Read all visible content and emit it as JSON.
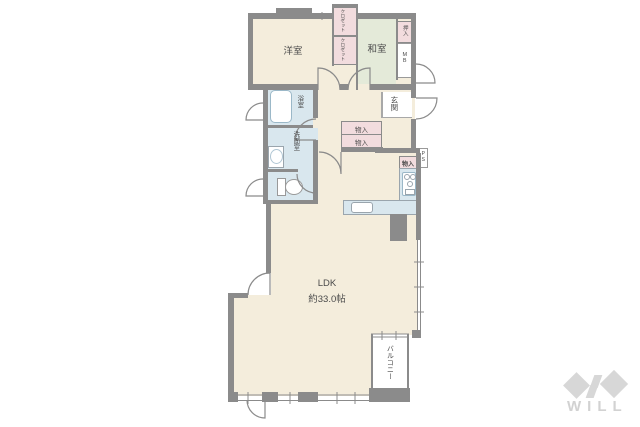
{
  "plan": {
    "rooms": {
      "western_room": "洋室",
      "japanese_room": "和室",
      "bath": "浴室",
      "washroom": "洗面室",
      "entrance": "玄関",
      "balcony": "バルコニー"
    },
    "area_label": {
      "line1": "LDK",
      "line2": "約33.0帖"
    },
    "storage": {
      "closets": [
        "クロゼット",
        "クロゼット"
      ],
      "oshiire": "押入",
      "hall_storage": [
        "物入",
        "物入"
      ],
      "kitchen_storage": "物入"
    },
    "utility": {
      "meter_box": "MB",
      "pipe_space": "PS"
    },
    "colors": {
      "room_beige": "#f4eddc",
      "tatami_green": "#e4ead9",
      "water_blue": "#d9e7ee",
      "storage_pink": "#f2dcde",
      "wall_gray": "#8b8b8b",
      "logo_gray": "#d7d7d7"
    },
    "logo": {
      "text": "WILL"
    }
  }
}
